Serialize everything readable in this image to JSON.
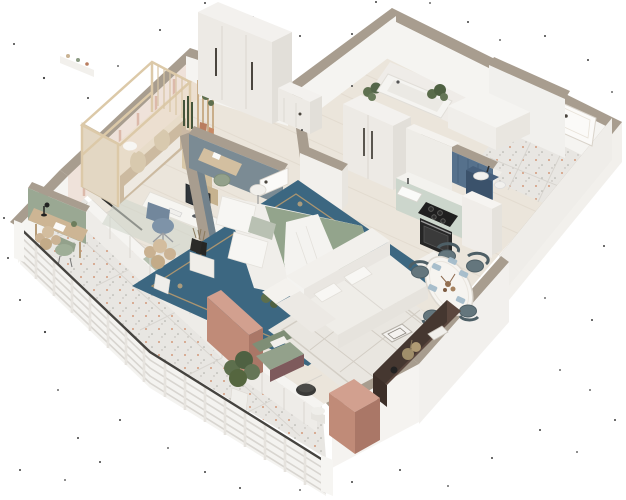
{
  "meta": {
    "kind": "3d-isometric-floor-plan-render",
    "view": "dollhouse cutaway, one-bedroom-plus-kids-room apartment with wrap-around balcony",
    "visible_text": []
  },
  "scene": {
    "rooms": [
      {
        "name": "kids-room",
        "furniture": [
          "house-frame-bunk-bed",
          "white-wardrobe",
          "desk-with-monitor",
          "blue-desk-chair",
          "wall-shelf",
          "slat-divider-with-plant",
          "snake-plant",
          "rug"
        ]
      },
      {
        "name": "master-bedroom",
        "furniture": [
          "double-bed-sage-duvet",
          "white-pillows",
          "ornate-blue-rug",
          "nightstand-with-black-vase",
          "round-marble-side-table",
          "vanity-desk",
          "sage-pouf",
          "open-white-door",
          "slate-accent-walls",
          "window-sill-cabinets"
        ]
      },
      {
        "name": "entry-hall",
        "furniture": [
          "entry-door",
          "tall-white-wardrobe",
          "radiator-cabinet",
          "terrazzo-tiles",
          "plants-on-wardrobe"
        ]
      },
      {
        "name": "bathroom",
        "furniture": [
          "bathtub",
          "blue-tile-wall",
          "mirror",
          "navy-vanity-sink",
          "toilet"
        ]
      },
      {
        "name": "kitchen",
        "furniture": [
          "mint-base-cabinets",
          "white-counter",
          "black-cooktop",
          "oven",
          "sink",
          "tall-cabinet-column",
          "white-cabinet-block"
        ]
      },
      {
        "name": "living-room",
        "furniture": [
          "white-sectional-sofa",
          "cream-lattice-rug",
          "oval-marble-dining-table",
          "teal-dining-chairs",
          "blue-placemats",
          "dark-brown-sideboard",
          "decor"
        ]
      },
      {
        "name": "balcony",
        "furniture": [
          "white-slat-railing",
          "terrazzo-floor",
          "desk-nook-with-lamp",
          "sage-chair",
          "pampas-plants",
          "green-lounge-chair",
          "black-coffee-table",
          "white-drum-table",
          "potted-plant",
          "pink-privacy-walls"
        ]
      }
    ]
  },
  "palette": {
    "bg": "#ffffff",
    "dot": "#1c1c1c",
    "wallTop": "#a89d8f",
    "wallFaceLight": "#f5f4f1",
    "wallFaceMid": "#efede9",
    "wallFaceShade": "#e7e4de",
    "wood": "#ebe5db",
    "plank": "#dcd4c7",
    "terr": "#e8e6e2",
    "terrGrout": "#d6d3cd",
    "speckOrange": "#c4693c",
    "speckGray": "#97958f",
    "railTop": "#45433f",
    "railFill": "#f4f3f0",
    "railSlat": "#d8d5d0",
    "railPost": "#e6e3de",
    "slate": "#72828c",
    "slateLit": "#7b8b94",
    "wallpaper": "#efe2da",
    "stripe": "#d8af9f",
    "furnTop": "#f3f1ee",
    "furnFront": "#edeae5",
    "furnSide": "#e2dfd9",
    "handle": "#4a453e",
    "bunkWood": "#e3d7c3",
    "bunkFront": "#e8dcc9",
    "bunkArch": "#d8c9ae",
    "bunkShade": "#b49f7e",
    "bunkDeck": "#ecdfd0",
    "canopy": "#dcc9a8",
    "kidsRug": "#d0d5cc",
    "chairBlue": "#7e93a8",
    "chairBlueDark": "#72879c",
    "monitor": "#30353a",
    "sageWall": "#9aa893",
    "deskWood": "#cdb594",
    "sageChair": "#93a18b",
    "pampas": "#cbb394",
    "potWhite": "#efeeea",
    "plantGreen": "#5d6f4d",
    "plantDark": "#44543a",
    "mauve": "#7e5a5c",
    "black": "#2b2b29",
    "copper": "#b97d5f",
    "pinkTop": "#d2a08f",
    "pink": "#c08b78",
    "pinkDark": "#aa7767",
    "tub": "#f5f4f1",
    "tubInner": "#ebe9e4",
    "blueTile": "#56718c",
    "blueTileLine": "#47617b",
    "vanityNavy": "#3b526b",
    "vanityNavyTop": "#47607c",
    "mint": "#ccd6cc",
    "counterTop": "#f3f2ee",
    "cooktop": "#1f1f1f",
    "oven": "#262626",
    "ovenGlass": "#3a3a3a",
    "rugBlue": "#3c6781",
    "rugBorder": "#c7a06b",
    "rugMotif": "#d8b27c",
    "medallion": "#4b7693",
    "mattress": "#f0eeea",
    "duvet": "#93a48c",
    "duvetDark": "#85977d",
    "pillow": "#f7f6f3",
    "throw": "#f4f3f0",
    "sofa": "#f2f0ec",
    "sofaShade": "#e9e6e1",
    "sofaSeat": "#efede8",
    "rugCream": "#e9e6e0",
    "rugLine": "#cfc9c0",
    "teal": "#64767d",
    "tealDark": "#4e5f66",
    "matBlue": "#a4bccb",
    "marble": "#f6f4f0",
    "sillSage": "#b5bfae",
    "slider": "#2f2f2d",
    "brownTop": "#5b473e",
    "brownFace": "#453730",
    "brownEnd": "#3d2f29",
    "doorLeaf": "#fbfaf8",
    "doorFrame": "#d9d3ca"
  }
}
